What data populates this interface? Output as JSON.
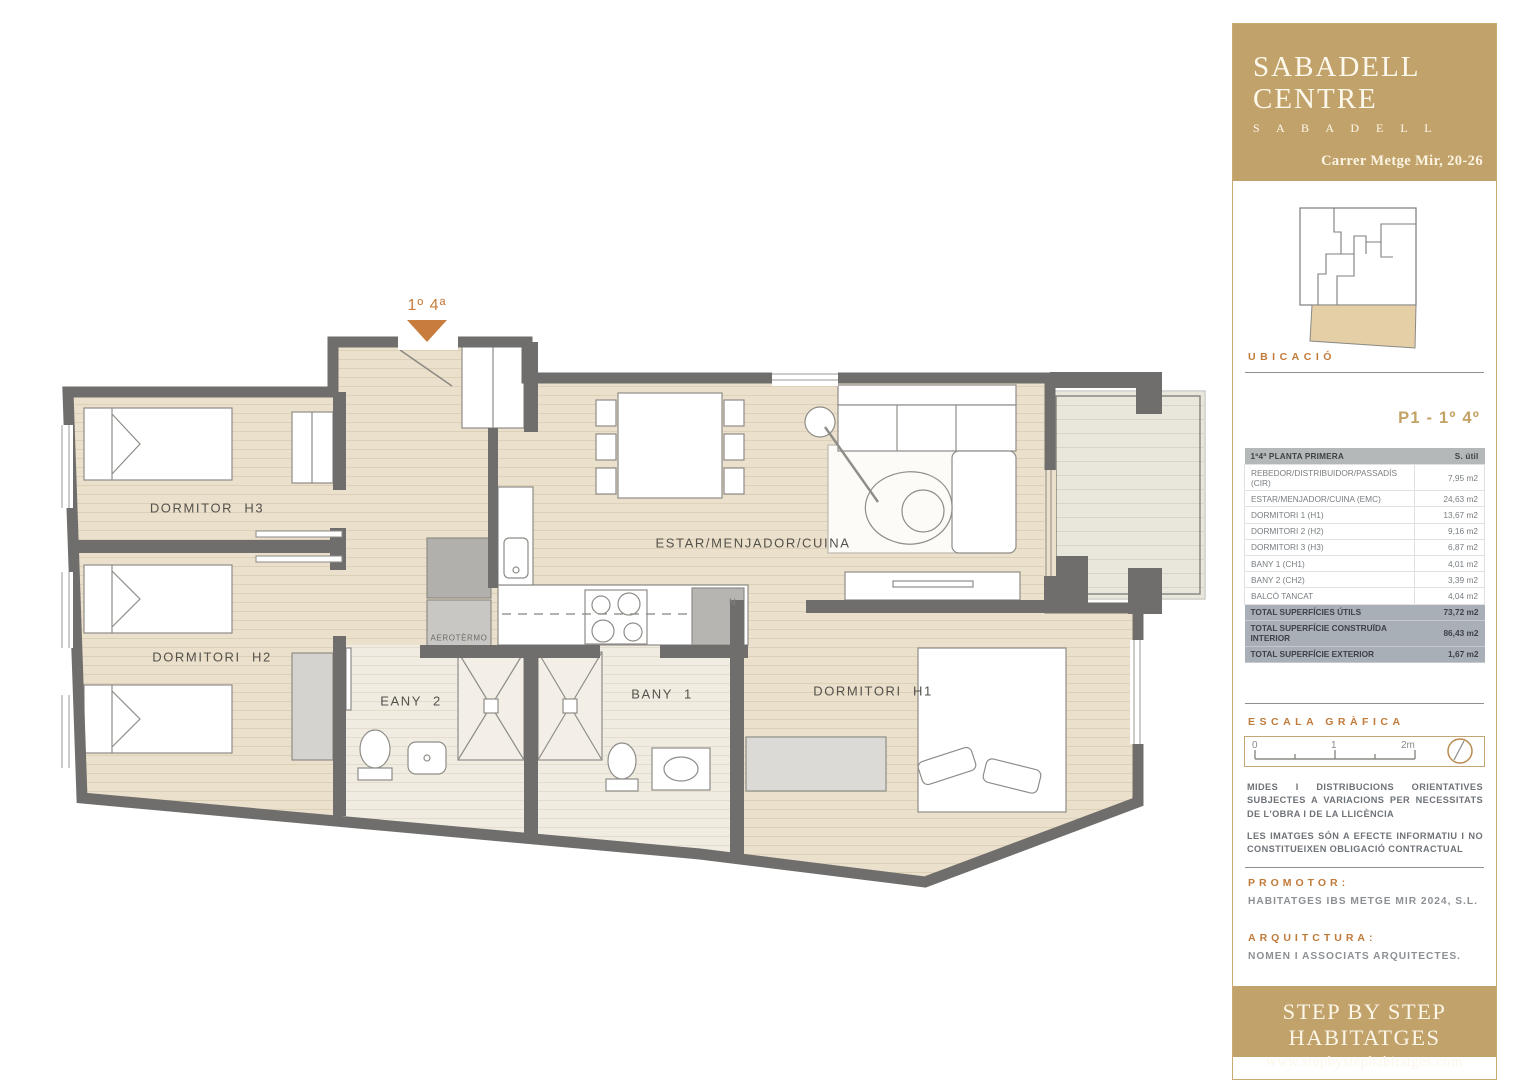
{
  "colors": {
    "gold": "#c2a26b",
    "accent_orange": "#c07a3a",
    "wall_gray": "#6f6e6c",
    "floor_beige": "#ebe0cb",
    "table_header_bg": "#b5b8b9",
    "table_total_bg": "#a8afb6"
  },
  "header": {
    "title_line1": "SABADELL",
    "title_line2": "CENTRE",
    "subtitle": "S A B A D E L L",
    "address": "Carrer Metge Mir, 20-26"
  },
  "location": {
    "label": "UBICACIÓ"
  },
  "unit_label": "P1 - 1º 4º",
  "areas_table": {
    "col_name": "1º4ª PLANTA PRIMERA",
    "col_value": "S. útil",
    "rows": [
      {
        "name": "REBEDOR/DISTRIBUIDOR/PASSADÍS (CIR)",
        "value": "7,95 m2"
      },
      {
        "name": "ESTAR/MENJADOR/CUINA (EMC)",
        "value": "24,63 m2"
      },
      {
        "name": "DORMITORI 1 (H1)",
        "value": "13,67 m2"
      },
      {
        "name": "DORMITORI 2 (H2)",
        "value": "9,16 m2"
      },
      {
        "name": "DORMITORI 3 (H3)",
        "value": "6,87 m2"
      },
      {
        "name": "BANY 1 (CH1)",
        "value": "4,01 m2"
      },
      {
        "name": "BANY 2 (CH2)",
        "value": "3,39 m2"
      },
      {
        "name": "BALCÓ TANCAT",
        "value": "4,04 m2"
      }
    ],
    "totals": [
      {
        "name": "TOTAL SUPERFÍCIES ÚTILS",
        "value": "73,72 m2"
      },
      {
        "name": "TOTAL SUPERFÍCIE CONSTRUÏDA INTERIOR",
        "value": "86,43 m2"
      },
      {
        "name": "TOTAL SUPERFÍCIE EXTERIOR",
        "value": "1,67 m2"
      }
    ]
  },
  "scale": {
    "label": "ESCALA GRÀFICA",
    "ticks": [
      "0",
      "1",
      "2m"
    ]
  },
  "disclaimers": {
    "p1": "MIDES I DISTRIBUCIONS ORIENTATIVES SUBJECTES A VARIACIONS PER NECESSITATS DE L'OBRA I DE LA LLICÈNCIA",
    "p2": "LES IMATGES SÓN A EFECTE INFORMATIU I NO CONSTITUEIXEN OBLIGACIÓ CONTRACTUAL"
  },
  "promoter": {
    "label": "PROMOTOR:",
    "name": "HABITATGES IBS METGE MIR 2024, S.L."
  },
  "architecture": {
    "label": "ARQUITCTURA:",
    "name": "NOMEN I ASSOCIATS ARQUITECTES."
  },
  "footer": {
    "brand": "STEP BY STEP HABITATGES",
    "website": "www.stepbystephabitatges.com"
  },
  "plan": {
    "entrance_label": "1º 4ª",
    "rooms": {
      "h3": "DORMITOR H3",
      "h2": "DORMITORI H2",
      "living": "ESTAR/MENJADOR/CUINA",
      "bany2": "EANY 2",
      "bany1": "BANY 1",
      "h1": "DORMITORI H1",
      "aerotermo": "AEROTÈRMO",
      "fridge": "N"
    }
  }
}
